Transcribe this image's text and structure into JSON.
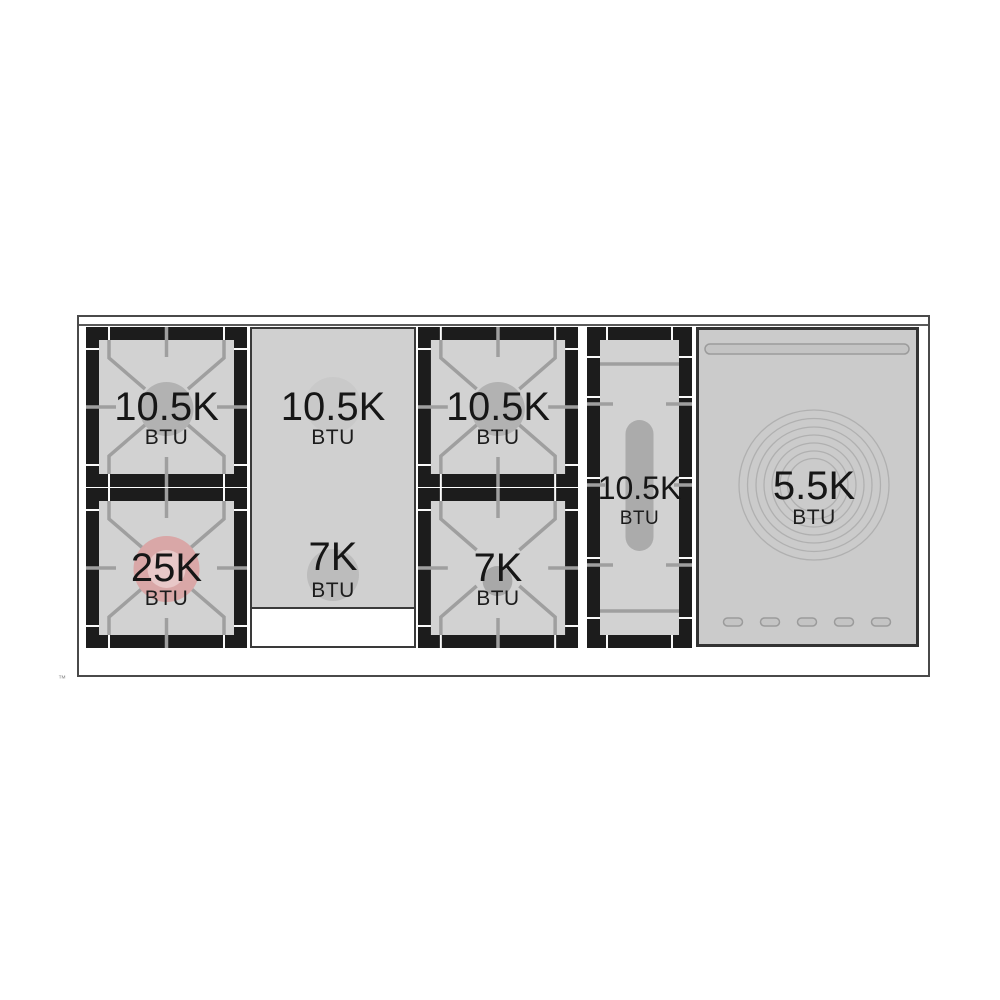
{
  "diagram_type": "range-cooktop-burner-layout",
  "colors": {
    "surface": "#d2d2d2",
    "griddle_surface": "#d0d0d0",
    "grate_frame": "#1c1c1c",
    "grate_lines": "#9f9f9f",
    "high_power_cap": "#d9a7a7",
    "high_power_cap_inner": "#e8c8c8",
    "standard_cap": "#b2b2b2",
    "warming_plate": "#cbcbcb",
    "text": "#161616"
  },
  "cooktop": {
    "sections": [
      {
        "name": "left-burner-column",
        "type": "gas-burner-pair",
        "burners": [
          {
            "power": "10.5K",
            "unit": "BTU",
            "cap_color": "#b2b2b2"
          },
          {
            "power": "25K",
            "unit": "BTU",
            "cap_color": "#d9a7a7",
            "cap_inner_color": "#e8c8c8"
          }
        ]
      },
      {
        "name": "griddle-zone",
        "type": "griddle-with-dual-zones",
        "zones": [
          {
            "power": "10.5K",
            "unit": "BTU",
            "cap_color": "#c9c9c9"
          },
          {
            "power": "7K",
            "unit": "BTU",
            "cap_color": "#bcbcbc"
          }
        ]
      },
      {
        "name": "center-burner-column",
        "type": "gas-burner-pair",
        "burners": [
          {
            "power": "10.5K",
            "unit": "BTU",
            "cap_color": "#b2b2b2"
          },
          {
            "power": "7K",
            "unit": "BTU",
            "cap_color": "#a8a8a8"
          }
        ]
      },
      {
        "name": "oval-burner",
        "type": "gas-oval-burner",
        "power": "10.5K",
        "unit": "BTU",
        "cap_color": "#ababab"
      },
      {
        "name": "warming-zone",
        "type": "warming-plate",
        "power": "5.5K",
        "unit": "BTU",
        "ring_count": 7,
        "button_count": 5
      }
    ]
  },
  "footnote": {
    "trademark": "™"
  }
}
